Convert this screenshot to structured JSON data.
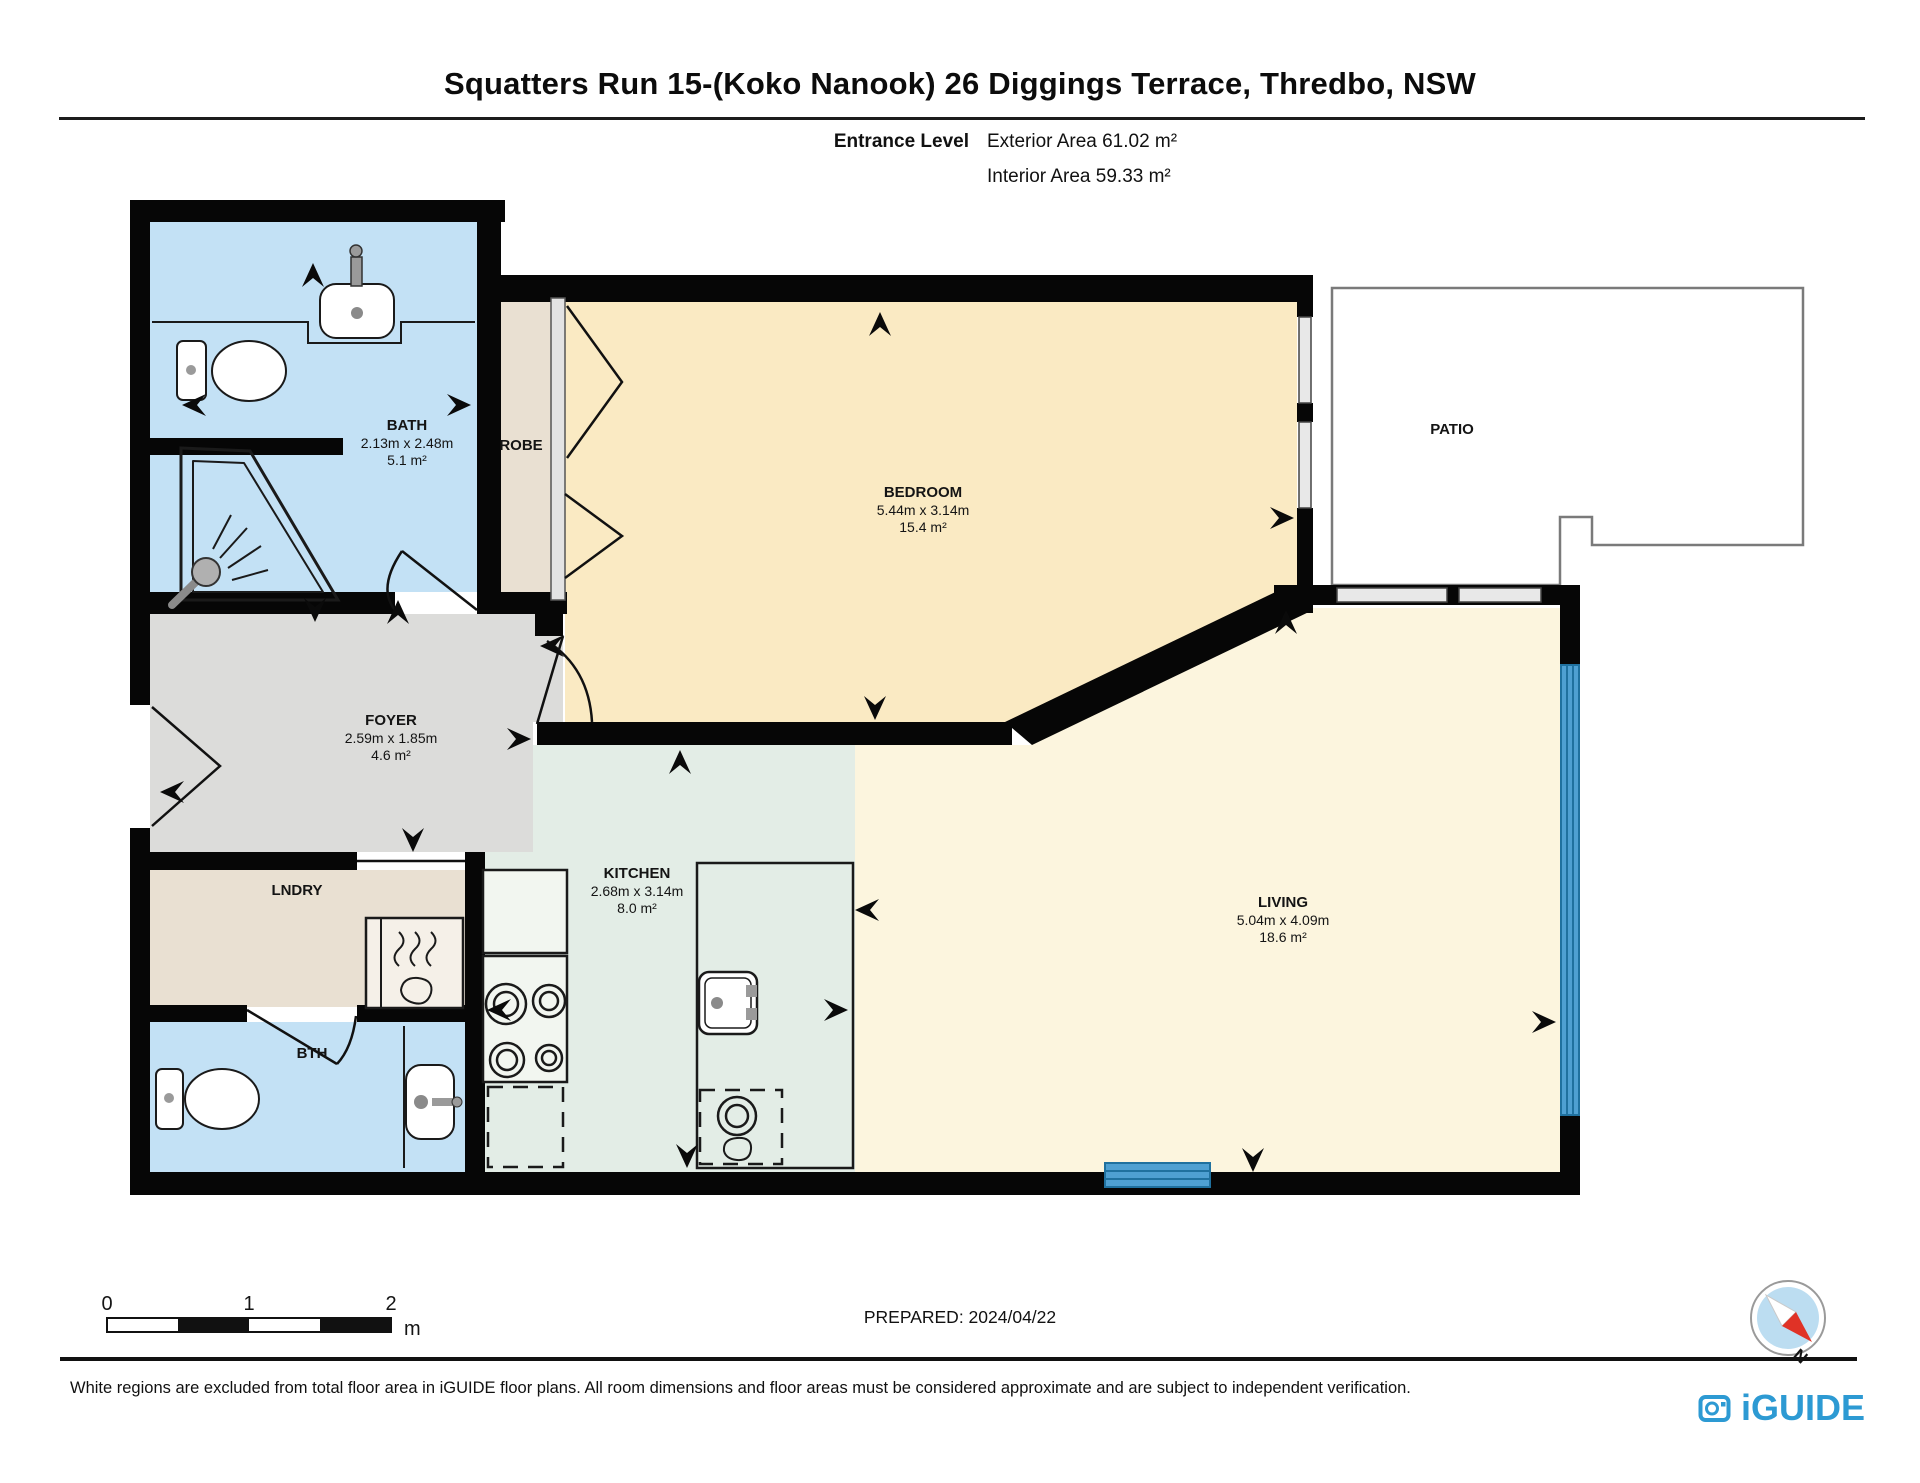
{
  "title": "Squatters Run 15-(Koko Nanook) 26 Diggings Terrace, Thredbo, NSW",
  "header": {
    "level_label": "Entrance Level",
    "exterior_area": "Exterior Area 61.02 m²",
    "interior_area": "Interior Area 59.33 m²"
  },
  "rooms": {
    "bath": {
      "name": "BATH",
      "dims": "2.13m x 2.48m",
      "area": "5.1 m²"
    },
    "robe": {
      "name": "ROBE"
    },
    "bedroom": {
      "name": "BEDROOM",
      "dims": "5.44m x 3.14m",
      "area": "15.4 m²"
    },
    "patio": {
      "name": "PATIO"
    },
    "foyer": {
      "name": "FOYER",
      "dims": "2.59m x 1.85m",
      "area": "4.6 m²"
    },
    "kitchen": {
      "name": "KITCHEN",
      "dims": "2.68m x 3.14m",
      "area": "8.0 m²"
    },
    "living": {
      "name": "LIVING",
      "dims": "5.04m x 4.09m",
      "area": "18.6 m²"
    },
    "laundry": {
      "name": "LNDRY"
    },
    "bth": {
      "name": "BTH"
    }
  },
  "scale_bar": {
    "ticks": [
      "0",
      "1",
      "2"
    ],
    "unit": "m"
  },
  "prepared": "PREPARED: 2024/04/22",
  "compass": {
    "north_label": "N"
  },
  "footer": {
    "disclaimer": "White regions are excluded from total floor area in iGUIDE floor plans. All room dimensions and floor areas must be considered approximate and are subject to independent verification.",
    "brand": "iGUIDE"
  },
  "colors": {
    "wall": "#000000",
    "bath_fill": "#C3E1F5",
    "bedroom_fill": "#FAEAC3",
    "living_fill": "#FCF5DE",
    "kitchen_fill": "#E3EDE6",
    "foyer_fill": "#DCDCDA",
    "robe_laundry_fill": "#E9E0D2",
    "window_glass_blue": "#4FA0D2",
    "window_gray": "#E3E3E3",
    "brand_blue": "#2D9AD3",
    "compass_red": "#E03226",
    "compass_blue": "#BCDDF1"
  }
}
